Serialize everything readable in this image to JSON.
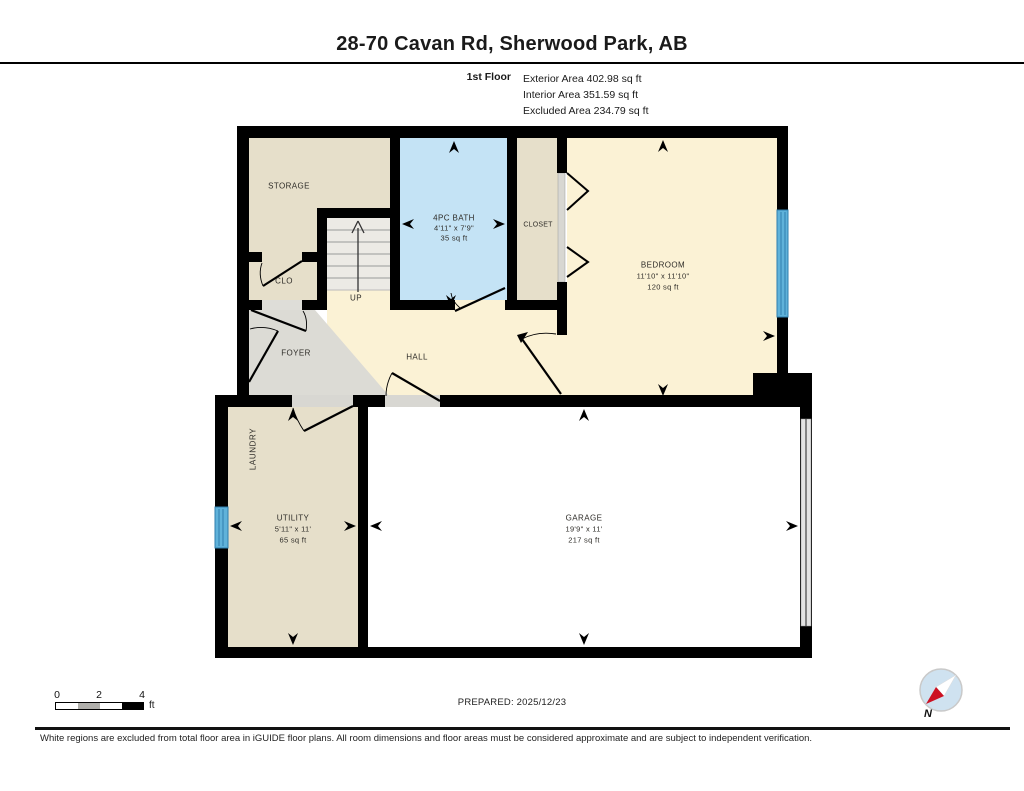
{
  "header": {
    "title": "28-70 Cavan Rd, Sherwood Park, AB",
    "floor_label": "1st Floor",
    "exterior_area": "Exterior Area 402.98 sq ft",
    "interior_area": "Interior Area 351.59 sq ft",
    "excluded_area": "Excluded Area 234.79 sq ft"
  },
  "rooms": {
    "storage": {
      "label": "STORAGE"
    },
    "clo": {
      "label": "CLO"
    },
    "stairs": {
      "label": "UP"
    },
    "bath": {
      "label": "4PC BATH",
      "dims": "4'11\" x 7'9\"",
      "area": "35 sq ft"
    },
    "closet": {
      "label": "CLOSET"
    },
    "bedroom": {
      "label": "BEDROOM",
      "dims": "11'10\" x 11'10\"",
      "area": "120 sq ft"
    },
    "foyer": {
      "label": "FOYER"
    },
    "hall": {
      "label": "HALL"
    },
    "laundry": {
      "label": "LAUNDRY"
    },
    "utility": {
      "label": "UTILITY",
      "dims": "5'11\" x 11'",
      "area": "65 sq ft"
    },
    "garage": {
      "label": "GARAGE",
      "dims": "19'9\" x 11'",
      "area": "217 sq ft"
    }
  },
  "footer": {
    "scale": {
      "tick0": "0",
      "tick2": "2",
      "tick4": "4",
      "unit": "ft"
    },
    "prepared": "PREPARED: 2025/12/23",
    "disclaimer": "White regions are excluded from total floor area in iGUIDE floor plans. All room dimensions and floor areas must be considered approximate and are subject to independent verification.",
    "compass": "N"
  },
  "colors": {
    "wall": "#000000",
    "room_beige": "#e6dfca",
    "bath_blue": "#c4e3f5",
    "bedroom_cream": "#fbf2d5",
    "foyer_gray": "#dcdbd5",
    "stairs_gray": "#eceae5",
    "garage_white": "#ffffff",
    "window_blue": "#5fb2da",
    "compass_red": "#cc1122"
  }
}
